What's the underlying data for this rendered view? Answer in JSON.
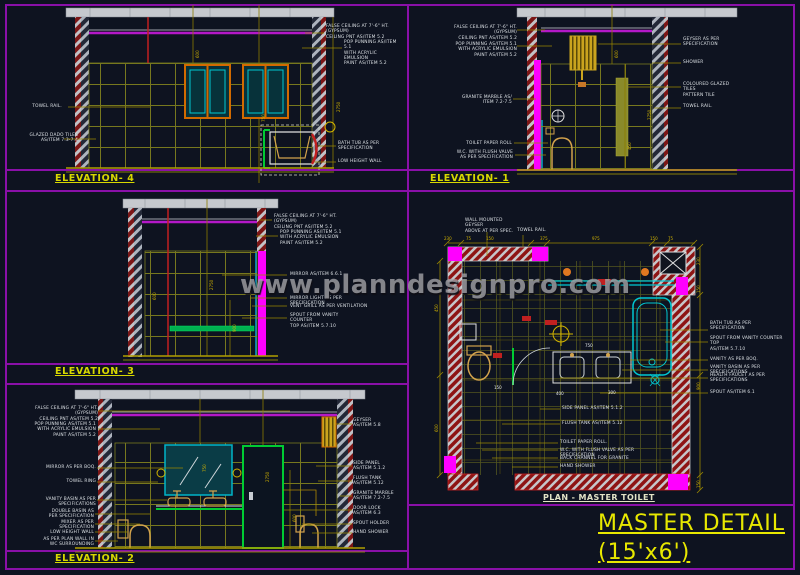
{
  "sheet": {
    "watermark": "www.planndesignpro.com",
    "title": "MASTER DETAIL",
    "subtitle": "(15'x6')"
  },
  "colors": {
    "background": "#0e1320",
    "border_purple": "#8a10a8",
    "false_ceiling_magenta": "#b418c8",
    "accent_magenta": "#ff00ff",
    "tile_olive": "#8a8a1e",
    "cad_yellow": "#d8d800",
    "leader_yellow": "#9a8800",
    "annotation_white": "#dde2e6",
    "wall_red": "#8e1414",
    "slab_gray": "#c6c9ce",
    "fixture_cyan": "#00c8d2",
    "frame_green": "#00cc33",
    "window_orange": "#d26a00"
  },
  "panels": {
    "elevation4": {
      "title": "ELEVATION- 4",
      "labels": {
        "towel_rail": "TOWEL RAIL.",
        "dado_tiles": "GLAZED DADO TILES\nAS/ITEM 7.3-7.4",
        "false_ceiling": "FALSE CEILING AT 7'-6\" HT. (GYPSUM)\nCEILING PNT AS/ITEM 5.2",
        "pop_punning": "POP PUNNING AS/ITEM 5.1\nWITH ACRYLIC EMULSION\nPAINT AS/ITEM 5.2",
        "bath_tub": "BATH TUB AS PER\nSPECIFICATION",
        "low_height_wall": "LOW HEIGHT WALL"
      },
      "dims": [
        "2750",
        "750",
        "600"
      ]
    },
    "elevation1": {
      "title": "ELEVATION- 1",
      "labels": {
        "false_ceiling": "FALSE CEILING AT 7'-6\" HT. (GYPSUM)\nCEILING PNT AS/ITEM 5.2",
        "pop_punning": "POP PUNNING AS/ITEM 5.1\nWITH ACRYLIC EMULSION\nPAINT AS/ITEM 5.2",
        "granite_marble": "GRANITE MARBLE AS/\nITEM 7.2-7.5",
        "toilet_paper": "TOILET PAPER ROLL",
        "wc_flush": "W.C. WITH FLUSH VALVE\nAS PER SPECIFICATION",
        "geyser": "GEYSER AS PER\nSPECIFICATION",
        "shower": "SHOWER",
        "coloured_tiles": "COLOURED GLAZED TILES\nPATTERN TILE",
        "towel_rail": "TOWEL RAIL."
      },
      "dims": [
        "2750",
        "600",
        "450"
      ]
    },
    "elevation3": {
      "title": "ELEVATION- 3",
      "labels": {
        "false_ceiling": "FALSE CEILING AT 7'-6\" HT. (GYPSUM)\nCEILING PNT AS/ITEM 5.2",
        "pop_punning": "POP PUNNING AS/ITEM 5.1\nWITH ACRYLIC EMULSION\nPAINT AS/ITEM 5.2",
        "mirror": "MIRROR AS/ITEM 6.6.1",
        "mirror_light": "MIRROR LIGHT AS PER SPECIFICATION",
        "vent_grill": "VENT GRILL AS PER VENTILATION",
        "spout_counter": "SPOUT FROM VANITY COUNTER\nTOP AS/ITEM 5.7.10"
      },
      "dims": [
        "2750",
        "900",
        "600"
      ]
    },
    "elevation2": {
      "title": "ELEVATION- 2",
      "labels": {
        "false_ceiling": "FALSE CEILING AT 7'-6\" HT. (GYPSUM)\nCEILING PNT AS/ITEM 5.2",
        "pop_punning": "POP PUNNING AS/ITEM 5.1\nWITH ACRYLIC EMULSION\nPAINT AS/ITEM 5.2",
        "mirror": "MIRROR AS PER BOQ.",
        "towel_ring": "TOWEL RING",
        "vanity_basin": "VANITY BASIN AS PER SPECIFICATIONS",
        "double_basin": "DOUBLE BASIN AS\nPER SPECIFICATION",
        "mixer": "MIXER AS PER\nSPECIFICATION",
        "low_height_wall": "LOW HEIGHT WALL",
        "plan_wall": "AS PER PLAN WALL IN\nWC SURROUNDING",
        "geyser": "GEYSER\nAS/ITEM 5.8",
        "side_panel": "SIDE PANEL\nAS/ITEM 5.1.2",
        "flush_tank": "FLUSH TANK\nAS/ITEM 5.12",
        "granite_marble": "GRANITE MARBLE\nAS/ITEM 7.2-7.5",
        "door_lock": "DOOR LOCK\nAS/ITEM 6.3",
        "spout_holder": "SPOUT HOLDER",
        "hand_shower": "HAND SHOWER"
      },
      "dims": [
        "2750",
        "750",
        "600"
      ]
    },
    "plan": {
      "title": "PLAN - MASTER TOILET",
      "labels": {
        "geyser_above": "WALL MOUNTED GEYSER\nABOVE AT PER SPEC.",
        "towel_rail": "TOWEL RAIL.",
        "bath_tub": "BATH TUB AS PER\nSPECIFICATION",
        "spout_counter": "SPOUT FROM VANITY COUNTER TOP\nAS/ITEM 5.7.10",
        "vanity": "VANITY AS PER BOQ.",
        "vanity_basin": "VANITY BASIN AS PER SPECIFICATIONS",
        "health_faucet": "HEALTH FAUCET AS PER\nSPECIFICATIONS",
        "spout": "SPOUT AS/ITEM 6.1",
        "side_panel": "SIDE PANEL AS/ITEM 5.1.2",
        "flush_tank": "FLUSH TANK AS/ITEM 5.12",
        "toilet_paper": "TOILET PAPER ROLL.",
        "wc_flush": "W.C. WITH FLUSH VALVE AS PER SPECIFICATION",
        "back_channel": "BACK CHANNEL FOR GRANITE",
        "hand_shower": "HAND SHOWER"
      },
      "dims_top": [
        "230",
        "75",
        "150",
        "375",
        "975",
        "150",
        "75"
      ],
      "dims_right": [
        "230",
        "150",
        "900",
        "150"
      ],
      "dims_left": [
        "450",
        "600"
      ],
      "dims_inner": [
        "400",
        "300",
        "150",
        "750"
      ]
    }
  }
}
